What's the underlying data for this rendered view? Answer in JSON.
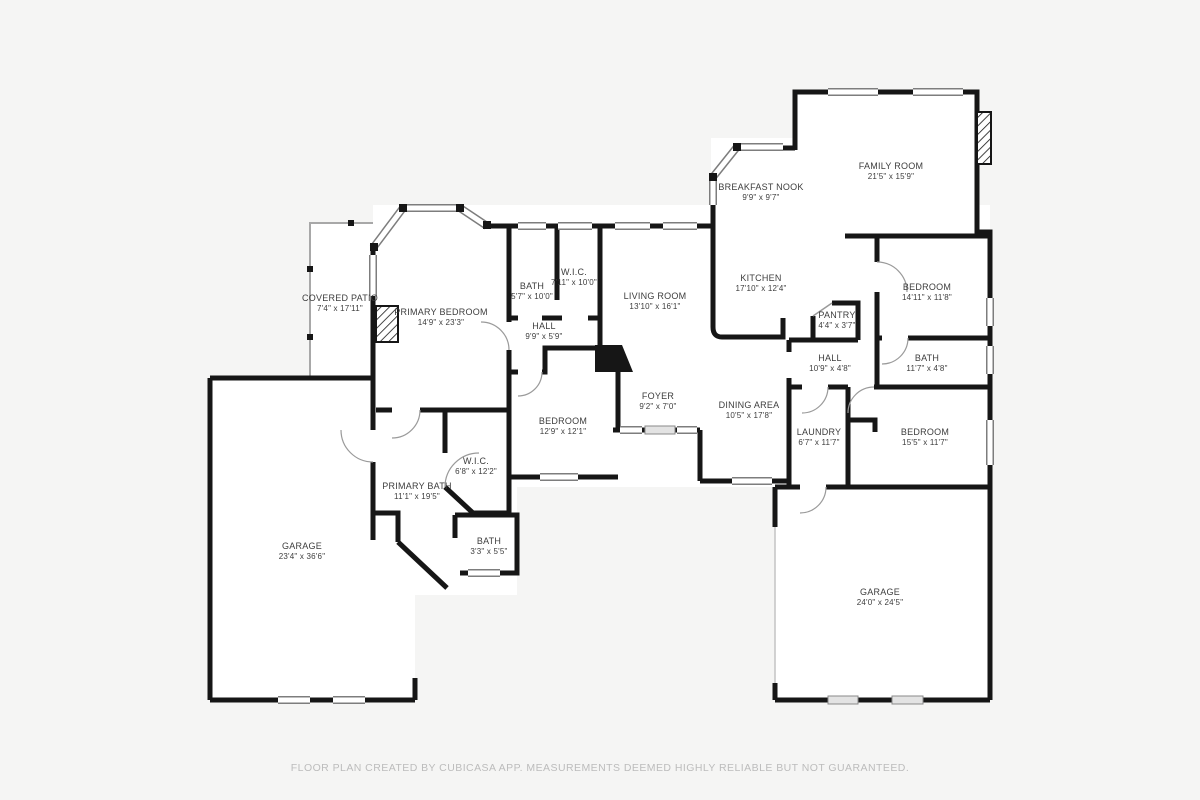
{
  "page": {
    "title": "Residential Floor Plan",
    "footer": "FLOOR PLAN CREATED BY CUBICASA APP. MEASUREMENTS DEEMED HIGHLY RELIABLE BUT NOT GUARANTEED."
  },
  "palette": {
    "background": "#f5f5f4",
    "wall": "#161616",
    "floor": "#ffffff",
    "label_text": "#3d3d3d",
    "footer_text": "#bcbcbc",
    "window_frame": "#7d7d7d",
    "patio_outline": "#a8a8a8",
    "door_arc": "#9a9a9a",
    "garage_door": "#e3e3e3"
  },
  "icons": [
    {
      "name": "fireplace-icon",
      "style": "diagonal-hatch",
      "count": 2
    },
    {
      "name": "window-icon",
      "style": "double-line-band"
    },
    {
      "name": "door-arc-icon",
      "style": "quarter-circle"
    }
  ],
  "rooms": [
    {
      "name": "COVERED PATIO",
      "dims": "7'4\" x 17'11\"",
      "cx": 340,
      "cy": 303
    },
    {
      "name": "PRIMARY BEDROOM",
      "dims": "14'9\" x 23'3\"",
      "cx": 441,
      "cy": 317
    },
    {
      "name": "BATH",
      "dims": "5'7\" x 10'0\"",
      "cx": 532,
      "cy": 291
    },
    {
      "name": "W.I.C.",
      "dims": "7'11\" x 10'0\"",
      "cx": 574,
      "cy": 277
    },
    {
      "name": "HALL",
      "dims": "9'9\" x 5'9\"",
      "cx": 544,
      "cy": 331
    },
    {
      "name": "LIVING ROOM",
      "dims": "13'10\" x 16'1\"",
      "cx": 655,
      "cy": 301
    },
    {
      "name": "BREAKFAST NOOK",
      "dims": "9'9\" x 9'7\"",
      "cx": 761,
      "cy": 192
    },
    {
      "name": "FAMILY ROOM",
      "dims": "21'5\" x 15'9\"",
      "cx": 891,
      "cy": 171
    },
    {
      "name": "KITCHEN",
      "dims": "17'10\" x 12'4\"",
      "cx": 761,
      "cy": 283
    },
    {
      "name": "BEDROOM",
      "dims": "14'11\" x 11'8\"",
      "cx": 927,
      "cy": 292
    },
    {
      "name": "PANTRY",
      "dims": "4'4\" x 3'7\"",
      "cx": 837,
      "cy": 320
    },
    {
      "name": "HALL",
      "dims": "10'9\" x 4'8\"",
      "cx": 830,
      "cy": 363
    },
    {
      "name": "BATH",
      "dims": "11'7\" x 4'8\"",
      "cx": 927,
      "cy": 363
    },
    {
      "name": "FOYER",
      "dims": "9'2\" x 7'0\"",
      "cx": 658,
      "cy": 401
    },
    {
      "name": "DINING AREA",
      "dims": "10'5\" x 17'8\"",
      "cx": 749,
      "cy": 410
    },
    {
      "name": "LAUNDRY",
      "dims": "6'7\" x 11'7\"",
      "cx": 819,
      "cy": 437
    },
    {
      "name": "BEDROOM",
      "dims": "15'5\" x 11'7\"",
      "cx": 925,
      "cy": 437
    },
    {
      "name": "BEDROOM",
      "dims": "12'9\" x 12'1\"",
      "cx": 563,
      "cy": 426
    },
    {
      "name": "W.I.C.",
      "dims": "6'8\" x 12'2\"",
      "cx": 476,
      "cy": 466
    },
    {
      "name": "PRIMARY BATH",
      "dims": "11'1\" x 19'5\"",
      "cx": 417,
      "cy": 491
    },
    {
      "name": "BATH",
      "dims": "3'3\" x 5'5\"",
      "cx": 489,
      "cy": 546
    },
    {
      "name": "GARAGE",
      "dims": "23'4\" x 36'6\"",
      "cx": 302,
      "cy": 551
    },
    {
      "name": "GARAGE",
      "dims": "24'0\" x 24'5\"",
      "cx": 880,
      "cy": 597
    }
  ]
}
